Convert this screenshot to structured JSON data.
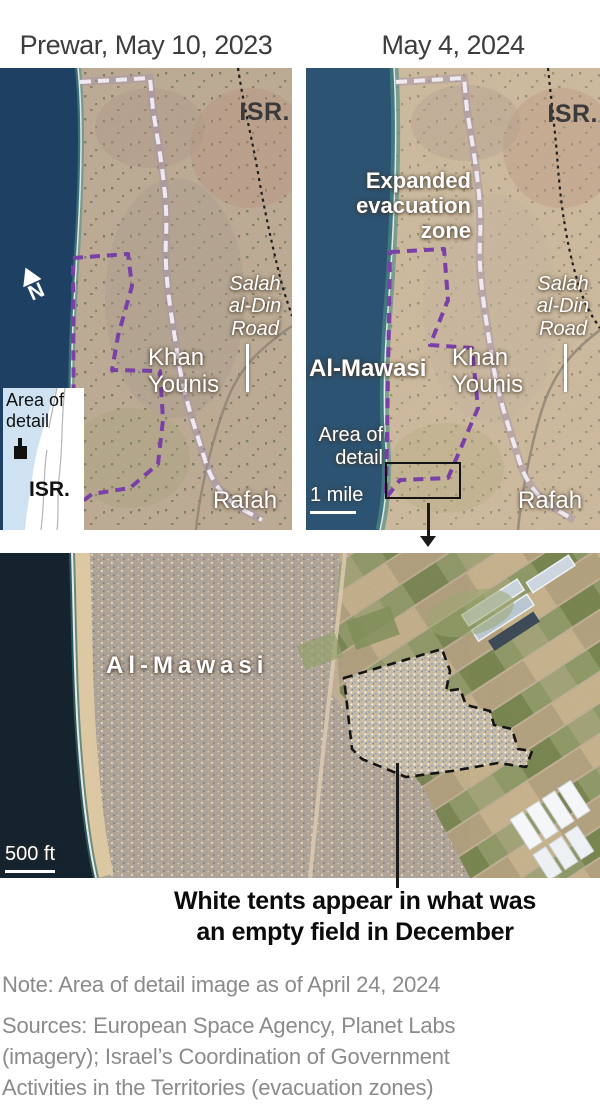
{
  "titles": {
    "left": "Prewar, May 10, 2023",
    "right": "May 4, 2024"
  },
  "colors": {
    "evacuation_dash": "#efe9f2",
    "mawasi_zone_purple": "#7b3fa8",
    "israel_border_black": "#1f1f1f",
    "sea_left": "#1e4062",
    "sea_right": "#2c5372",
    "land_tan": "#c9b69c"
  },
  "map_left": {
    "isr_label": "ISR.",
    "road_label": "Salah\nal-Din\nRoad",
    "khan_label": "Khan\nYounis",
    "rafah_label": "Rafah",
    "north_label": "N",
    "inset": {
      "area_label": "Area of\ndetail",
      "isr_label": "ISR."
    }
  },
  "map_right": {
    "isr_label": "ISR.",
    "expanded_label": "Expanded\nevacuation\nzone",
    "almawasi_label": "Al-Mawasi",
    "road_label": "Salah\nal-Din\nRoad",
    "khan_label": "Khan\nYounis",
    "area_detail_label": "Area of\ndetail",
    "scale_label": "1 mile",
    "rafah_label": "Rafah"
  },
  "detail": {
    "almawasi_label": "Al-Mawasi",
    "scale_label": "500 ft"
  },
  "caption": "White tents appear in what was\nan empty field in December",
  "note": "Note: Area of detail image as of April 24, 2024",
  "sources": "Sources: European Space Agency, Planet Labs\n(imagery); Israel’s Coordination of Government\nActivities in the Territories (evacuation zones)"
}
